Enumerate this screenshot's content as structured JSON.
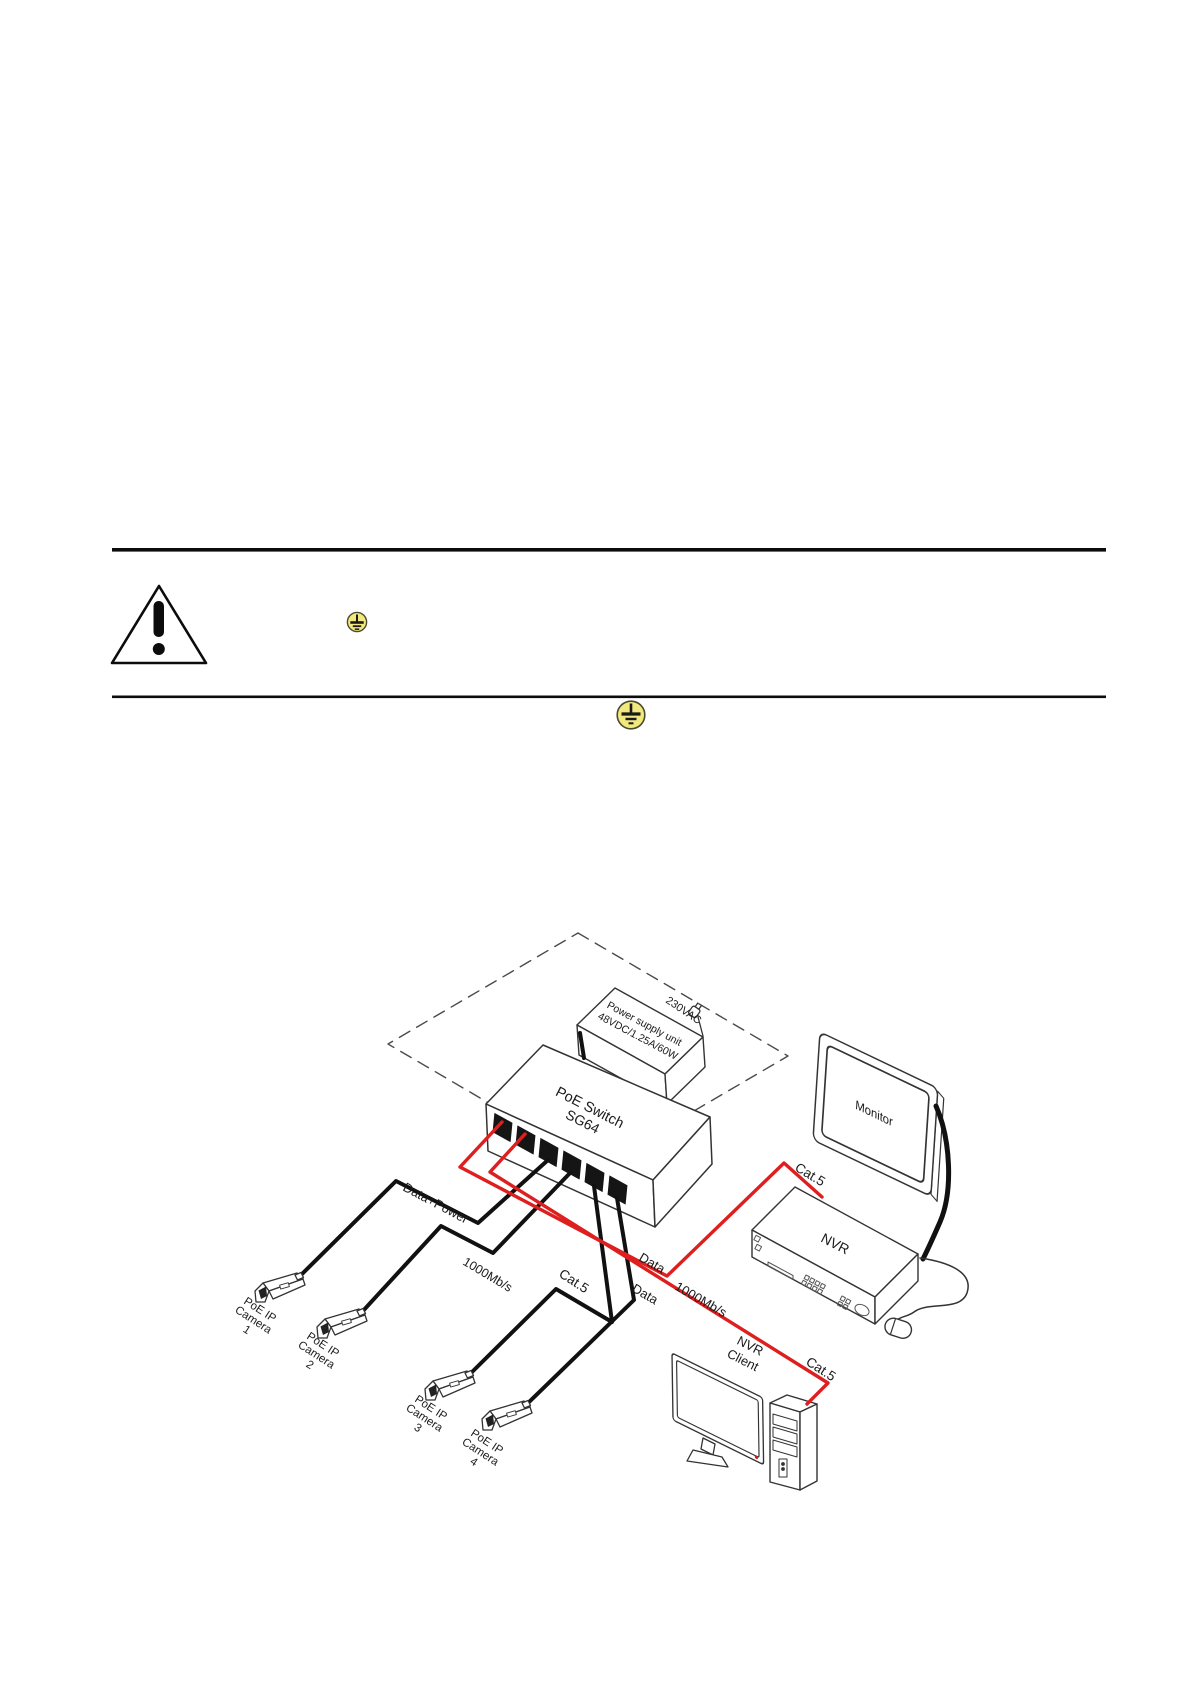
{
  "page": {
    "background": "#ffffff"
  },
  "diagram": {
    "colors": {
      "cable_black": "#111111",
      "cable_red": "#de1f1f",
      "ground_fill": "#f1e87e",
      "outline": "#333333"
    },
    "psu": {
      "line1": "Power supply unit",
      "line2": "48VDC/1.25A/60W",
      "mains": "230VAC"
    },
    "switch": {
      "line1": "PoE Switch",
      "line2": "SG64"
    },
    "monitor": {
      "label": "Monitor"
    },
    "nvr": {
      "label": "NVR"
    },
    "client": {
      "line1": "NVR",
      "line2": "Client"
    },
    "cameras": [
      {
        "l1": "PoE IP",
        "l2": "Camera",
        "l3": "1"
      },
      {
        "l1": "PoE IP",
        "l2": "Camera",
        "l3": "2"
      },
      {
        "l1": "PoE IP",
        "l2": "Camera",
        "l3": "3"
      },
      {
        "l1": "PoE IP",
        "l2": "Camera",
        "l3": "4"
      }
    ],
    "labels": {
      "data_power": "Data+Power",
      "mbps_black": "1000Mb/s",
      "cat5_black": "Cat.5",
      "data_nvr": "Data",
      "data_client": "Data",
      "mbps_red": "1000Mb/s",
      "cat5_nvr": "Cat.5",
      "cat5_client": "Cat.5"
    }
  }
}
